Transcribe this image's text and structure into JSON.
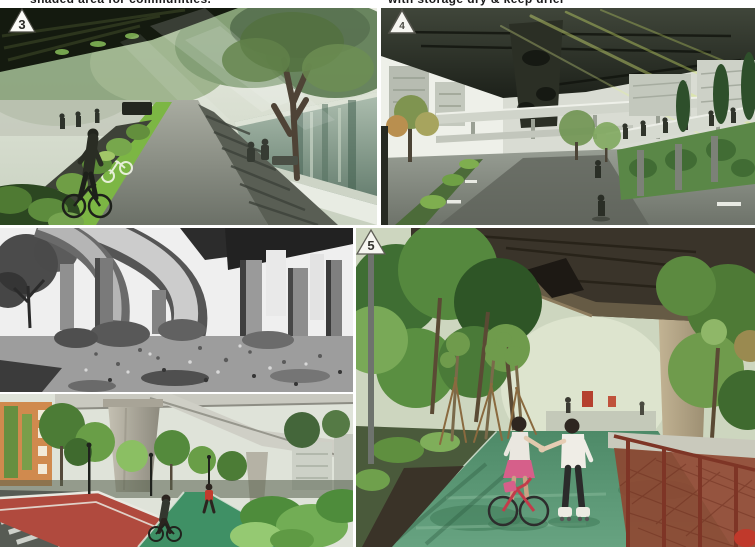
{
  "document": {
    "background": "#ffffff",
    "kind": "five-panel collage of an under-expressway park transformation"
  },
  "captions": {
    "top_left": "shaded area for communities.",
    "top_right": "with storage dry & keep drier"
  },
  "markers": {
    "canal_park": "3",
    "street": "4",
    "green_path": "5"
  },
  "panels": {
    "p1": "rendering: canal-side park with green bike lane under elevated road",
    "p2": "rendering: street under expressway with elevated walkway and green walls",
    "p3": "black-and-white photo: derelict ground under highway ramps (before)",
    "p4": "photo: red and green cycle paths under viaduct (after)",
    "p5": "photo: children on green path under expressway, girl on bicycle and boy on skates"
  },
  "colors": {
    "bike_lane_green": "#7cb644",
    "red_path": "#b04a3e",
    "green_path": "#3f9065",
    "park_path_green": "#55976f",
    "fence_rust": "#7e3526",
    "canal_water": "#7f9a8a",
    "viaduct_dark": "#3a342a",
    "orange_building": "#d08a4e"
  }
}
